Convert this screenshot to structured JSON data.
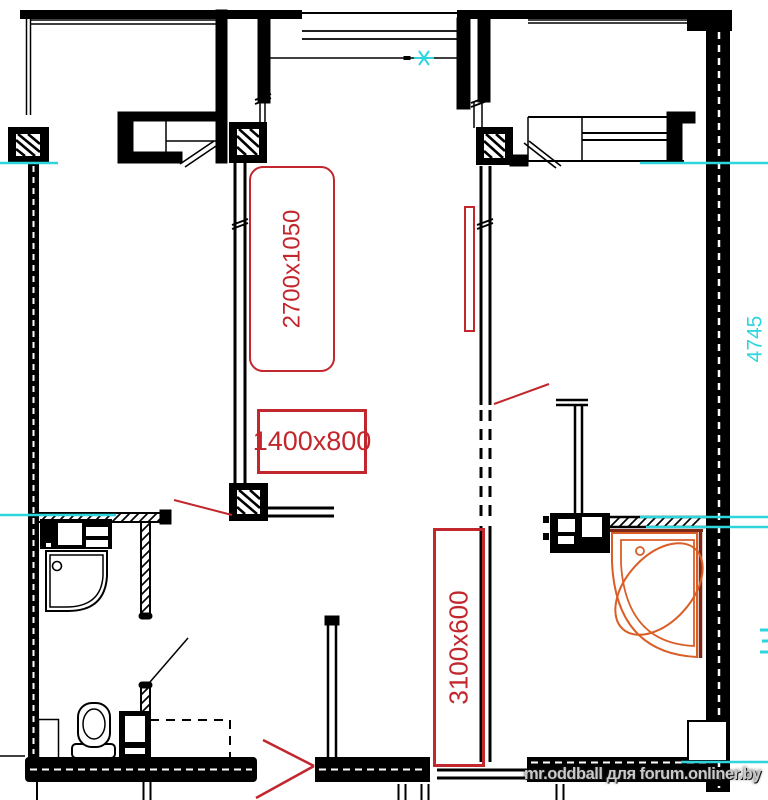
{
  "document": {
    "type": "apartment floor plan drawing"
  },
  "labels": {
    "furniture_size_vertical": "2700x1050",
    "window_size": "1400x800",
    "opening_size_vertical": "3100x600",
    "dimension_right_cyan": "4745",
    "watermark": "mr.oddball для forum.onliner.by"
  },
  "colors": {
    "walls": "#000000",
    "annotation_red": "#c1272d",
    "dimension_cyan": "#2ed5de",
    "bathtub_orange": "#d95f27",
    "bathtub_dark_red": "#7e2817",
    "watermark_gray": "#c9c9c9",
    "background": "#ffffff"
  },
  "fixtures": {
    "corner_bathtub": "corner bathtub",
    "shower_tray": "shower tray with drain",
    "toilet": "toilet",
    "vanity_sink": "vanity with washbasin",
    "washbasin_unit": "washbasin cabinet"
  }
}
